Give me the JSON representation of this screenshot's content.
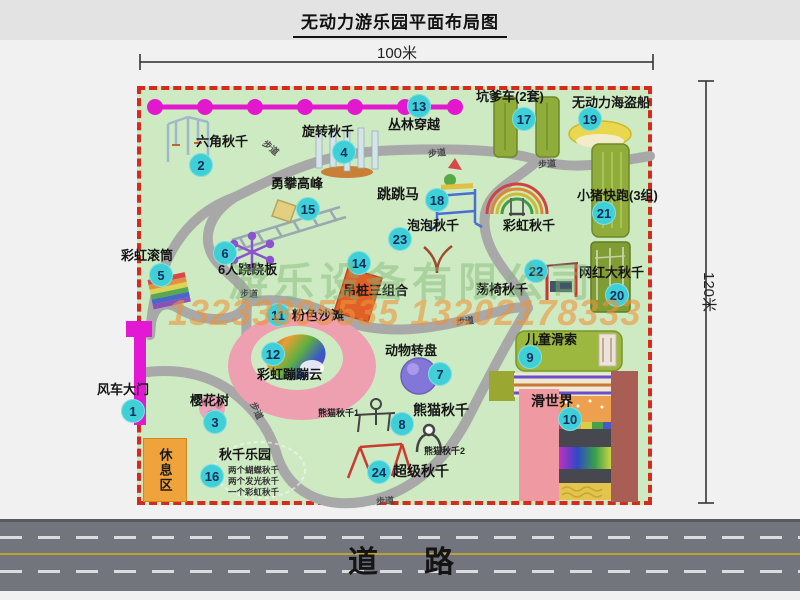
{
  "title": "无动力游乐园平面布局图",
  "dimensions": {
    "width": "100米",
    "height": "120米"
  },
  "road_label": "道路",
  "rest_area_label": "休息区",
  "trail_label": "步道",
  "watermark": {
    "company": "游乐设备有限公司",
    "phones": "13233805535 13202178333"
  },
  "rainbow_swing_label": "彩虹秋千",
  "panda_swing_sub1": "熊猫秋千1",
  "panda_swing_sub2": "熊猫秋千2",
  "swing_park_notes": [
    "两个蝴蝶秋千",
    "两个发光秋千",
    "一个彩虹秋千"
  ],
  "attractions": [
    {
      "num": "1",
      "label": "风车大门"
    },
    {
      "num": "2",
      "label": "六角秋千"
    },
    {
      "num": "3",
      "label": "樱花树"
    },
    {
      "num": "4",
      "label": "旋转秋千"
    },
    {
      "num": "5",
      "label": "彩虹滚筒"
    },
    {
      "num": "6",
      "label": "6人跷跷板"
    },
    {
      "num": "7",
      "label": "动物转盘"
    },
    {
      "num": "8",
      "label": "熊猫秋千"
    },
    {
      "num": "9",
      "label": "儿童滑索"
    },
    {
      "num": "10",
      "label": "滑世界"
    },
    {
      "num": "11",
      "label": "粉色沙滩"
    },
    {
      "num": "12",
      "label": "彩虹蹦蹦云"
    },
    {
      "num": "13",
      "label": "丛林穿越"
    },
    {
      "num": "14",
      "label": "吊桩三组合"
    },
    {
      "num": "15",
      "label": "勇攀高峰"
    },
    {
      "num": "16",
      "label": "秋千乐园"
    },
    {
      "num": "17",
      "label": "坑爹车(2套)"
    },
    {
      "num": "18",
      "label": "跳跳马"
    },
    {
      "num": "19",
      "label": "无动力海盗船"
    },
    {
      "num": "20",
      "label": "网红大秋千"
    },
    {
      "num": "21",
      "label": "小猪快跑(3组)"
    },
    {
      "num": "22",
      "label": "荡椅秋千"
    },
    {
      "num": "23",
      "label": "泡泡秋千"
    },
    {
      "num": "24",
      "label": "超级秋千"
    }
  ]
}
